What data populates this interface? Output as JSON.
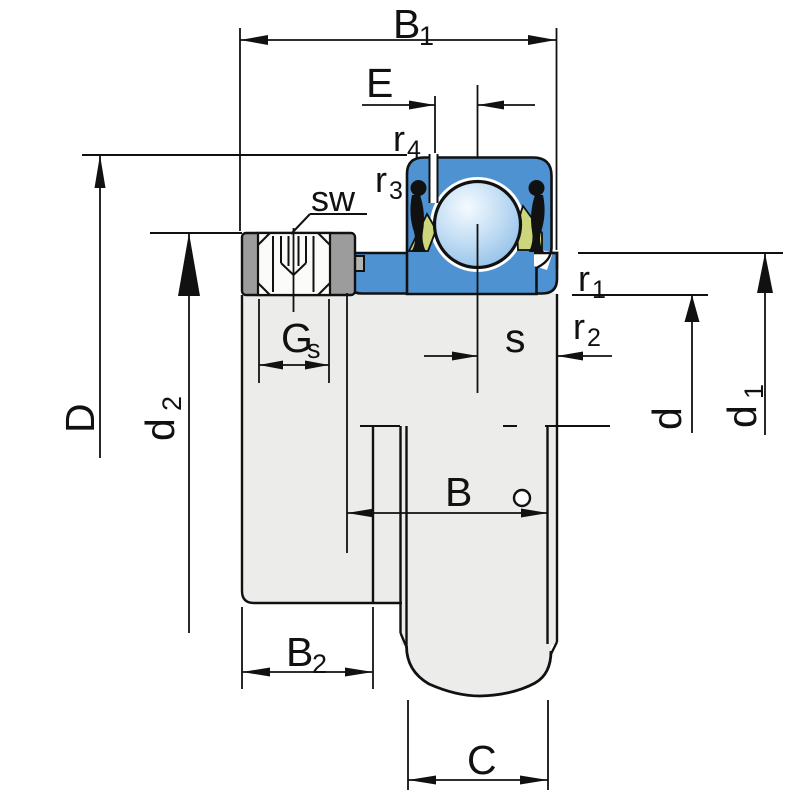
{
  "drawing": {
    "type": "bearing-dimension-drawing",
    "labels": {
      "b1": {
        "main": "B",
        "sub": "1"
      },
      "e": {
        "main": "E"
      },
      "r4": {
        "main": "r",
        "sub": "4"
      },
      "r3": {
        "main": "r",
        "sub": "3"
      },
      "sw": {
        "main": "sw"
      },
      "gs": {
        "main": "G",
        "sub": "s"
      },
      "s": {
        "main": "s"
      },
      "r1": {
        "main": "r",
        "sub": "1"
      },
      "r2": {
        "main": "r",
        "sub": "2"
      },
      "b": {
        "main": "B"
      },
      "b2": {
        "main": "B",
        "sub": "2"
      },
      "c": {
        "main": "C"
      },
      "d_upper": {
        "main": "D"
      },
      "d2": {
        "main": "d",
        "sub": "2"
      },
      "d": {
        "main": "d"
      },
      "d1": {
        "main": "d",
        "sub": "1"
      }
    },
    "colors": {
      "ring_blue": "#4e92d2",
      "ball_highlight": "#f4faff",
      "ball_mid": "#c7e0f5",
      "ball_edge": "#8abce7",
      "cage_yellow": "#ccd77c",
      "collar_gray": "#9c9c9c",
      "collar_tab": "#b4b4b4",
      "steel_light": "#ecedea",
      "screw_white": "#fbfbfa",
      "line": "#111111"
    }
  }
}
